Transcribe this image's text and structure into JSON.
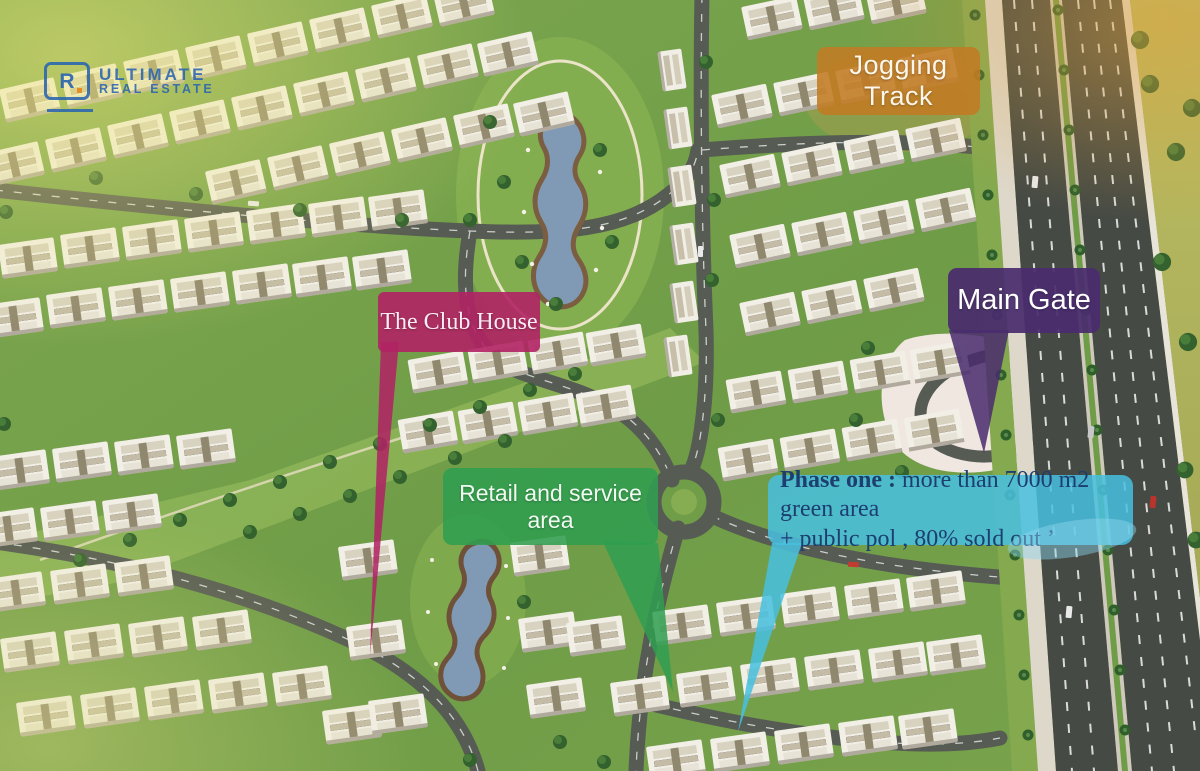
{
  "brand": {
    "name_line1": "ULTIMATE",
    "name_line2": "REAL ESTATE",
    "mark_letter": "R",
    "primary_color": "#2a66b0",
    "accent_color": "#e8891d"
  },
  "callouts": {
    "jogging_track": {
      "label": "Jogging Track",
      "color": "#c27b23"
    },
    "main_gate": {
      "label": "Main Gate",
      "color": "#492c6e"
    },
    "club_house": {
      "label": "The Club House",
      "color": "#b12264"
    },
    "retail": {
      "label": "Retail and service area",
      "color": "#309e50"
    },
    "phase_one": {
      "label_bold": "Phase one :",
      "label_line1": " more than 7000 m2 green area",
      "label_line2": "+ public pol , 80% sold out ’",
      "color": "#48c0e0",
      "text_color": "#1c3f70"
    }
  }
}
